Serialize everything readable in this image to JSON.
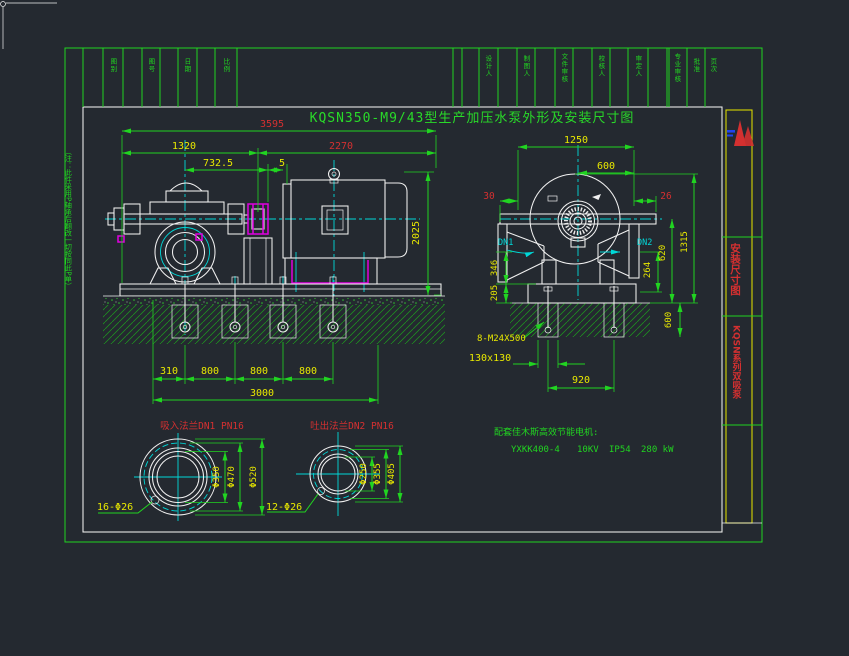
{
  "title": "KQSN350-M9/43型生产加压水泵外形及安装尺寸图",
  "margin_note": "（注：此件采用P轴承后翻改一切按同此P单）",
  "title_block": {
    "cells": [
      "图别",
      "图号",
      "日期",
      "比例",
      "设计人",
      "制图人",
      "文件审核",
      "校核人",
      "审定人",
      "专业审核",
      "批准",
      "页次"
    ]
  },
  "right_panel": {
    "label_install": "安装尺寸图",
    "label_series": "KQSN系列双吸泵"
  },
  "front_view": {
    "dims": {
      "total_length": "3595",
      "pump_length": "1320",
      "motor_length": "2270",
      "suction_to_coupling": "732.5",
      "coupling_gap": "5",
      "height": "2025",
      "bolt_offset": "310",
      "bolt_pitch_a": "800",
      "bolt_pitch_b": "800",
      "bolt_pitch_c": "800",
      "base_length": "3000"
    }
  },
  "end_view": {
    "labels": {
      "suction": "DN1",
      "discharge": "DN2"
    },
    "dims": {
      "overall_width": "1250",
      "discharge_offset": "600",
      "left_offset": "30",
      "right_offset": "26",
      "suction_height": "346",
      "base_height": "205",
      "flange_height": "264",
      "center_height": "620",
      "overall_height": "1315",
      "anchor_bolts": "8-M24X500",
      "pocket_size": "130x130",
      "bolt_span": "920",
      "foundation_depth": "600"
    }
  },
  "suction_flange": {
    "title": "吸入法兰DN1 PN16",
    "bore": "Φ350",
    "bolt_circle": "Φ470",
    "outer": "Φ520",
    "holes": "16-Φ26"
  },
  "discharge_flange": {
    "title": "吐出法兰DN2 PN16",
    "bore": "Φ250",
    "bolt_circle": "Φ355",
    "outer": "Φ405",
    "holes": "12-Φ26"
  },
  "motor_note": {
    "heading": "配套佳木斯高效节能电机:",
    "model": "YXKK400-4",
    "voltage": "10KV",
    "protection": "IP54",
    "power": "280 kW"
  },
  "colors": {
    "background": "#242930",
    "line_green": "#21d421",
    "dim_yellow": "#e8e800",
    "dim_red": "#d43030",
    "centerline_cyan": "#00d8d8",
    "detail_magenta": "#e000e0",
    "line_white": "#f0f0f0",
    "panel_yellow": "#d8d800"
  }
}
